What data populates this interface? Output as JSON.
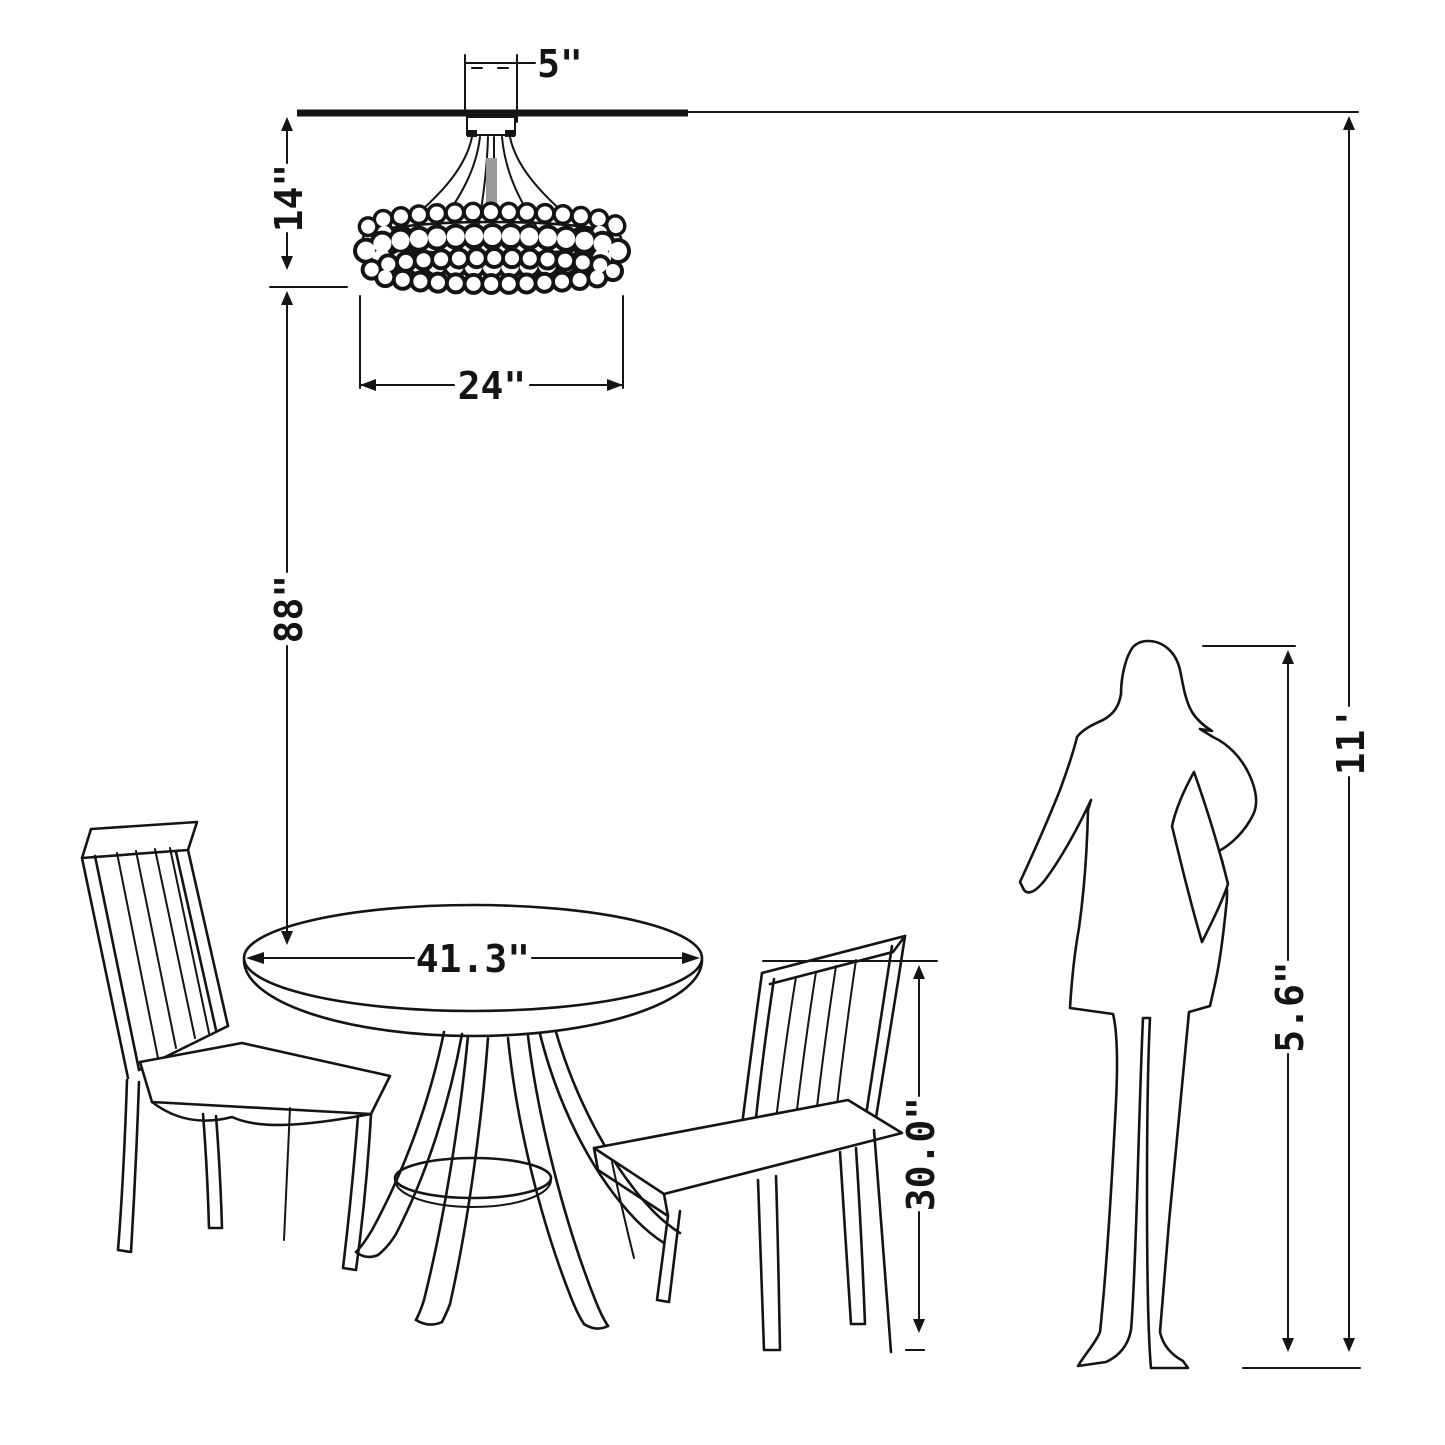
{
  "diagram": {
    "type": "furniture-dimension-diagram",
    "background_color": "#ffffff",
    "line_color": "#141414",
    "chandelier": {
      "canopy_width_label": "5\"",
      "height_label": "14\"",
      "diameter_label": "24\""
    },
    "clearance": {
      "ceiling_to_table_label": "88\""
    },
    "table": {
      "diameter_label": "41.3\"",
      "height_label": "30.0\""
    },
    "person": {
      "height_label": "5.6\""
    },
    "room": {
      "ceiling_height_label": "11'"
    }
  }
}
